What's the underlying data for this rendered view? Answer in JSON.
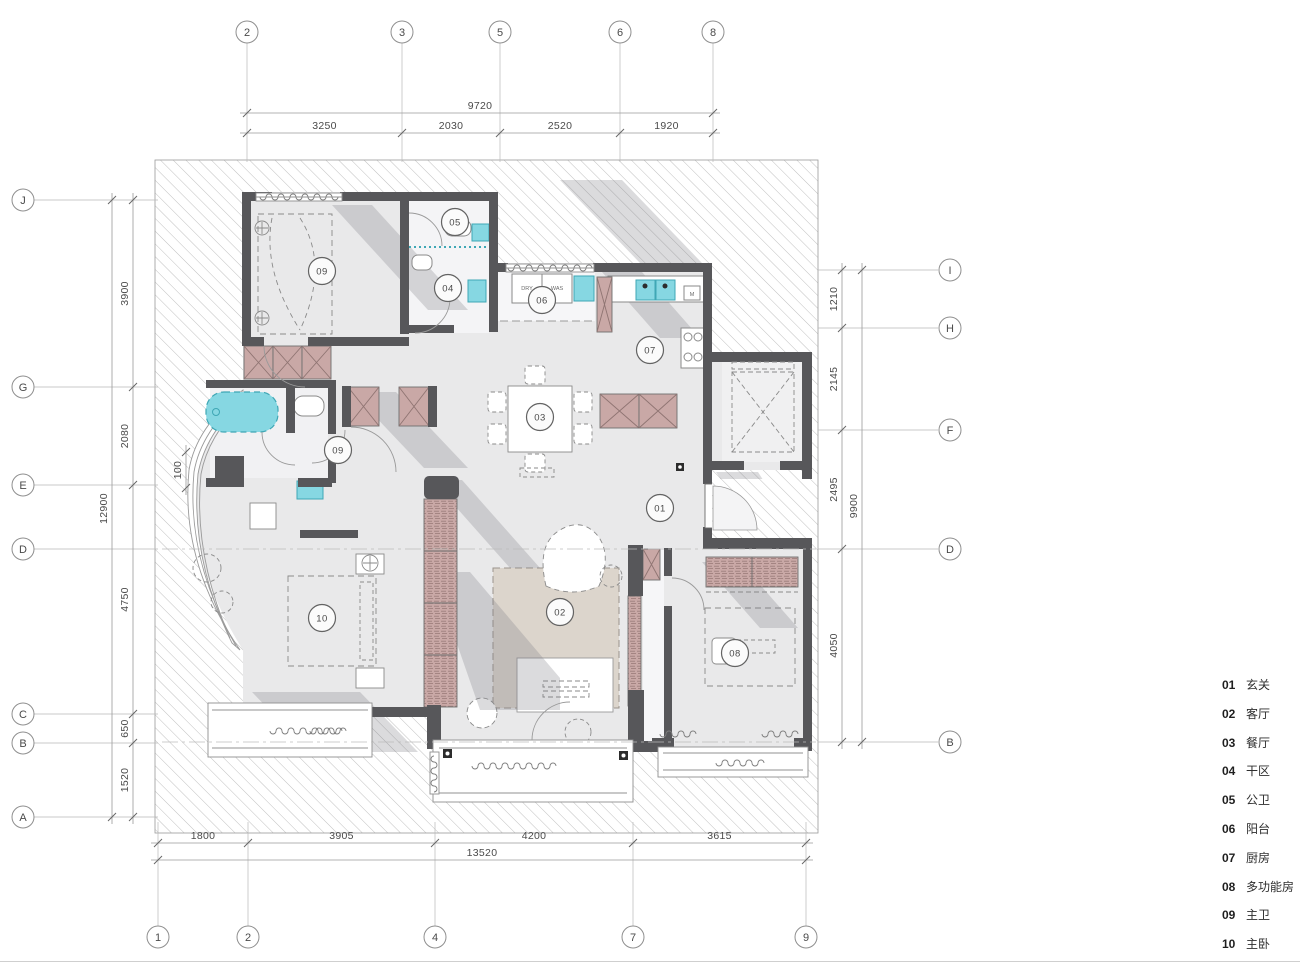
{
  "colors": {
    "wall": "#57575a",
    "floor": "#e9e9ea",
    "hatch_line": "#c0c0c0",
    "cabinet": "#c9a8a6",
    "cabinet_line": "#8f7472",
    "fixture_cyan": "#86d7e2",
    "fixture_cyan_line": "#3fa7b5",
    "rug": "#dcd5cc",
    "shadow": "rgba(125,125,132,0.28)"
  },
  "grid": {
    "top": {
      "cy": 32,
      "line_from": 43,
      "line_to": 162,
      "items": [
        {
          "label": "2",
          "x": 247
        },
        {
          "label": "3",
          "x": 402
        },
        {
          "label": "5",
          "x": 500
        },
        {
          "label": "6",
          "x": 620
        },
        {
          "label": "8",
          "x": 713
        }
      ]
    },
    "bottom": {
      "cy": 937,
      "line_from": 822,
      "line_to": 926,
      "items": [
        {
          "label": "1",
          "x": 158
        },
        {
          "label": "2",
          "x": 248
        },
        {
          "label": "4",
          "x": 435
        },
        {
          "label": "7",
          "x": 633
        },
        {
          "label": "9",
          "x": 806
        }
      ]
    },
    "left": {
      "cx": 23,
      "line_from": 34,
      "line_to": 158,
      "items": [
        {
          "label": "J",
          "y": 200
        },
        {
          "label": "G",
          "y": 387
        },
        {
          "label": "E",
          "y": 485
        },
        {
          "label": "D",
          "y": 549
        },
        {
          "label": "C",
          "y": 714
        },
        {
          "label": "B",
          "y": 743
        },
        {
          "label": "A",
          "y": 817
        }
      ]
    },
    "right": {
      "cx": 950,
      "line_from": 818,
      "line_to": 938,
      "items": [
        {
          "label": "I",
          "y": 270
        },
        {
          "label": "H",
          "y": 328
        },
        {
          "label": "F",
          "y": 430
        },
        {
          "label": "D",
          "y": 549
        },
        {
          "label": "B",
          "y": 742
        }
      ]
    }
  },
  "dimensions": {
    "horizontal": [
      {
        "name": "top-overall",
        "pos": 113,
        "points": [
          247,
          713
        ],
        "labels": [
          "9720"
        ]
      },
      {
        "name": "top-segments",
        "pos": 133,
        "points": [
          247,
          402,
          500,
          620,
          713
        ],
        "labels": [
          "3250",
          "2030",
          "2520",
          "1920"
        ]
      },
      {
        "name": "bottom-segments",
        "pos": 843,
        "points": [
          158,
          248,
          435,
          633,
          806
        ],
        "labels": [
          "1800",
          "3905",
          "4200",
          "3615"
        ]
      },
      {
        "name": "bottom-overall",
        "pos": 860,
        "points": [
          158,
          806
        ],
        "labels": [
          "13520"
        ]
      }
    ],
    "vertical": [
      {
        "name": "left-overall",
        "pos": 112,
        "points": [
          200,
          817
        ],
        "labels": [
          "12900"
        ]
      },
      {
        "name": "left-segments",
        "pos": 133,
        "points": [
          200,
          387,
          485,
          714,
          743,
          817
        ],
        "labels": [
          "3900",
          "2080",
          "4750",
          "650",
          "1520"
        ]
      },
      {
        "name": "right-segments",
        "pos": 842,
        "points": [
          270,
          328,
          430,
          549,
          742
        ],
        "labels": [
          "1210",
          "2145",
          "2495",
          "4050"
        ]
      },
      {
        "name": "right-overall",
        "pos": 862,
        "points": [
          270,
          742
        ],
        "labels": [
          "9900"
        ]
      },
      {
        "name": "bath-offset",
        "pos": 186,
        "points": [
          452,
          488
        ],
        "labels": [
          "100"
        ]
      }
    ]
  },
  "rooms": [
    {
      "num": "09",
      "x": 322,
      "y": 271
    },
    {
      "num": "05",
      "x": 455,
      "y": 222
    },
    {
      "num": "04",
      "x": 448,
      "y": 288
    },
    {
      "num": "06",
      "x": 542,
      "y": 300
    },
    {
      "num": "07",
      "x": 650,
      "y": 350
    },
    {
      "num": "03",
      "x": 540,
      "y": 417
    },
    {
      "num": "09",
      "x": 338,
      "y": 450
    },
    {
      "num": "01",
      "x": 660,
      "y": 508
    },
    {
      "num": "02",
      "x": 560,
      "y": 612
    },
    {
      "num": "10",
      "x": 322,
      "y": 618
    },
    {
      "num": "08",
      "x": 735,
      "y": 653
    }
  ],
  "appliance_labels": [
    {
      "text": "DRY",
      "x": 527,
      "y": 290
    },
    {
      "text": "WAS",
      "x": 557,
      "y": 290
    },
    {
      "text": "M",
      "x": 692,
      "y": 296
    }
  ],
  "legend": {
    "y_start": 684,
    "row_step": 28.8,
    "items": [
      {
        "num": "01",
        "name": "玄关"
      },
      {
        "num": "02",
        "name": "客厅"
      },
      {
        "num": "03",
        "name": "餐厅"
      },
      {
        "num": "04",
        "name": "干区"
      },
      {
        "num": "05",
        "name": "公卫"
      },
      {
        "num": "06",
        "name": "阳台"
      },
      {
        "num": "07",
        "name": "厨房"
      },
      {
        "num": "08",
        "name": "多功能房"
      },
      {
        "num": "09",
        "name": "主卫"
      },
      {
        "num": "10",
        "name": "主卧"
      }
    ]
  }
}
